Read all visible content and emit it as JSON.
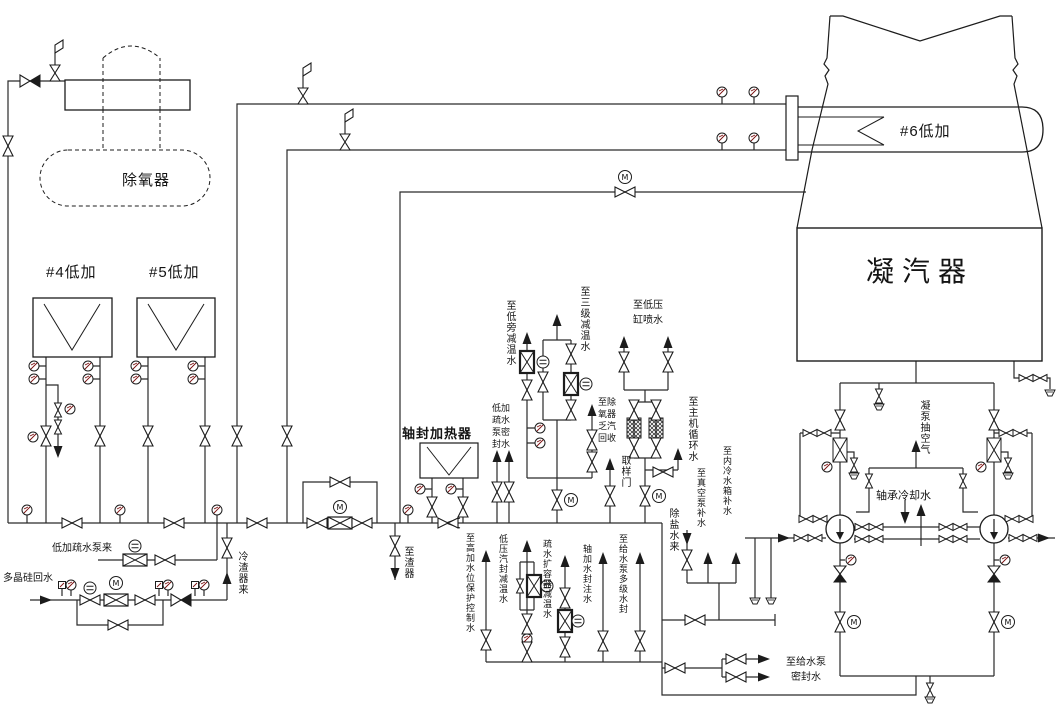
{
  "colors": {
    "line": "#1c1c1c",
    "background": "#ffffff"
  },
  "symbols": {
    "motor": "M"
  },
  "equipment": {
    "deaerator": "除氧器",
    "lp_heater_4": "#4低加",
    "lp_heater_5": "#5低加",
    "lp_heater_6": "#6低加",
    "condenser": "凝汽器",
    "gland_steam_heater": "轴封加热器"
  },
  "labels": {
    "to_lp_bypass_spray": "至低旁减温水",
    "to_stage3_spray": "至三级减温水",
    "lp_drain_pump_seal_water": "低加疏水泵密封水",
    "to_deaerator_exhaust_recovery": "至除氧器乏汽回收",
    "to_lp_cylinder_spray": "至低压\n缸喷水",
    "to_main_circ_water": "至主机循环水",
    "sampling_valve": "取样门",
    "demin_water_in": "除盐水来",
    "to_vacuum_pump_makeup": "至真空泵补水",
    "to_inner_cooling_tank_makeup": "至内冷水箱补水",
    "cond_pump_air_extraction": "凝泵抽空气",
    "bearing_cooling_water": "轴承冷却水",
    "to_feed_pump_seal_water": "至给水泵\n密封水",
    "from_lp_drain_pump": "低加疏水泵来",
    "polysilicon_return": "多晶硅回水",
    "from_slag_cooler": "冷渣器来",
    "to_slag_unit": "至渣器",
    "to_hp_heater_level_ctrl": "至高加水位保护控制水",
    "lp_gland_spray_water": "低压汽封减温水",
    "drain_flash_tank_spray": "疏水扩容器减温水",
    "gland_heater_seal_fill": "轴加水封注水",
    "to_feed_pump_multistage_seal": "至给水泵多级水封"
  }
}
